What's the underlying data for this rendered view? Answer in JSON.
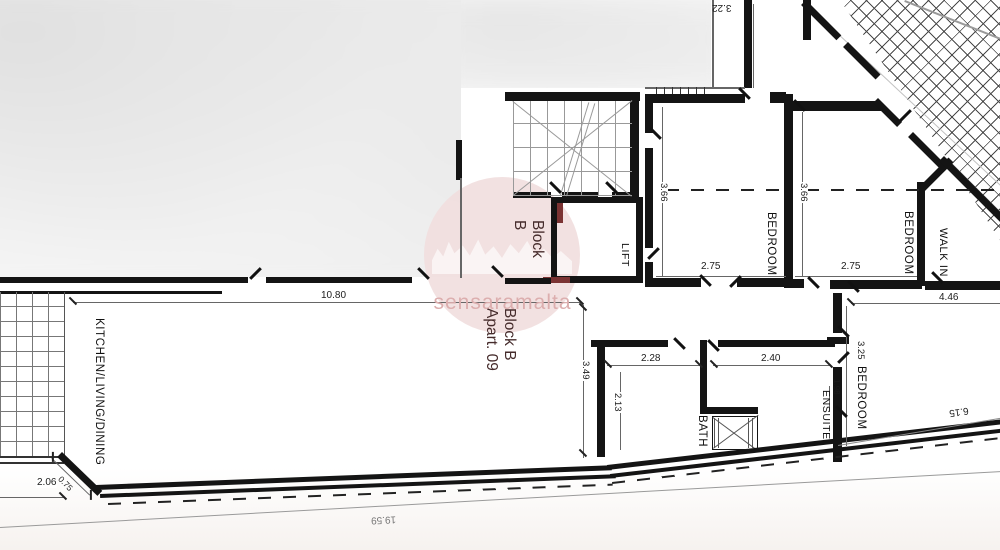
{
  "title": "Block B Apart. 09 floor plan",
  "watermark": {
    "text": "sensaramalta",
    "circle_color": "#f1dede",
    "text_color": "#dcaeae"
  },
  "lobby_label": {
    "line1": "Block",
    "line2": "B"
  },
  "apartment_label": {
    "line1": "Block B",
    "line2": "Apart. 09"
  },
  "rooms": {
    "kitchen": "KITCHEN/LIVING/DINING",
    "lift": "LIFT",
    "bedroom_top_left": "BEDROOM",
    "bedroom_top_right": "BEDROOM",
    "walk_in": "WALK IN",
    "bath": "BATH",
    "ensuite": "ENSUITE",
    "bedroom_bottom_right": "BEDROOM"
  },
  "dimensions": {
    "living_width": "10.80",
    "terrace_left": "2.06",
    "corner": "0.75",
    "overall_bottom": "19.59",
    "hall_bath_depth": "3.49",
    "bath_width": "2.28",
    "bath_depth": "2.13",
    "ensuite_width": "2.40",
    "ensuite_depth": "1.98",
    "bedroom3_depth": "3.25",
    "bedroom3_diagonal": "6.15",
    "bedroom3_width": "4.46",
    "bedroom1_width": "2.75",
    "bedroom1_depth": "3.66",
    "bedroom2_width": "2.75",
    "bedroom2_depth": "3.66",
    "upper_room": "3.22"
  },
  "colors": {
    "wall": "#141414",
    "dim_line": "#666",
    "label_red": "#452b2b"
  }
}
